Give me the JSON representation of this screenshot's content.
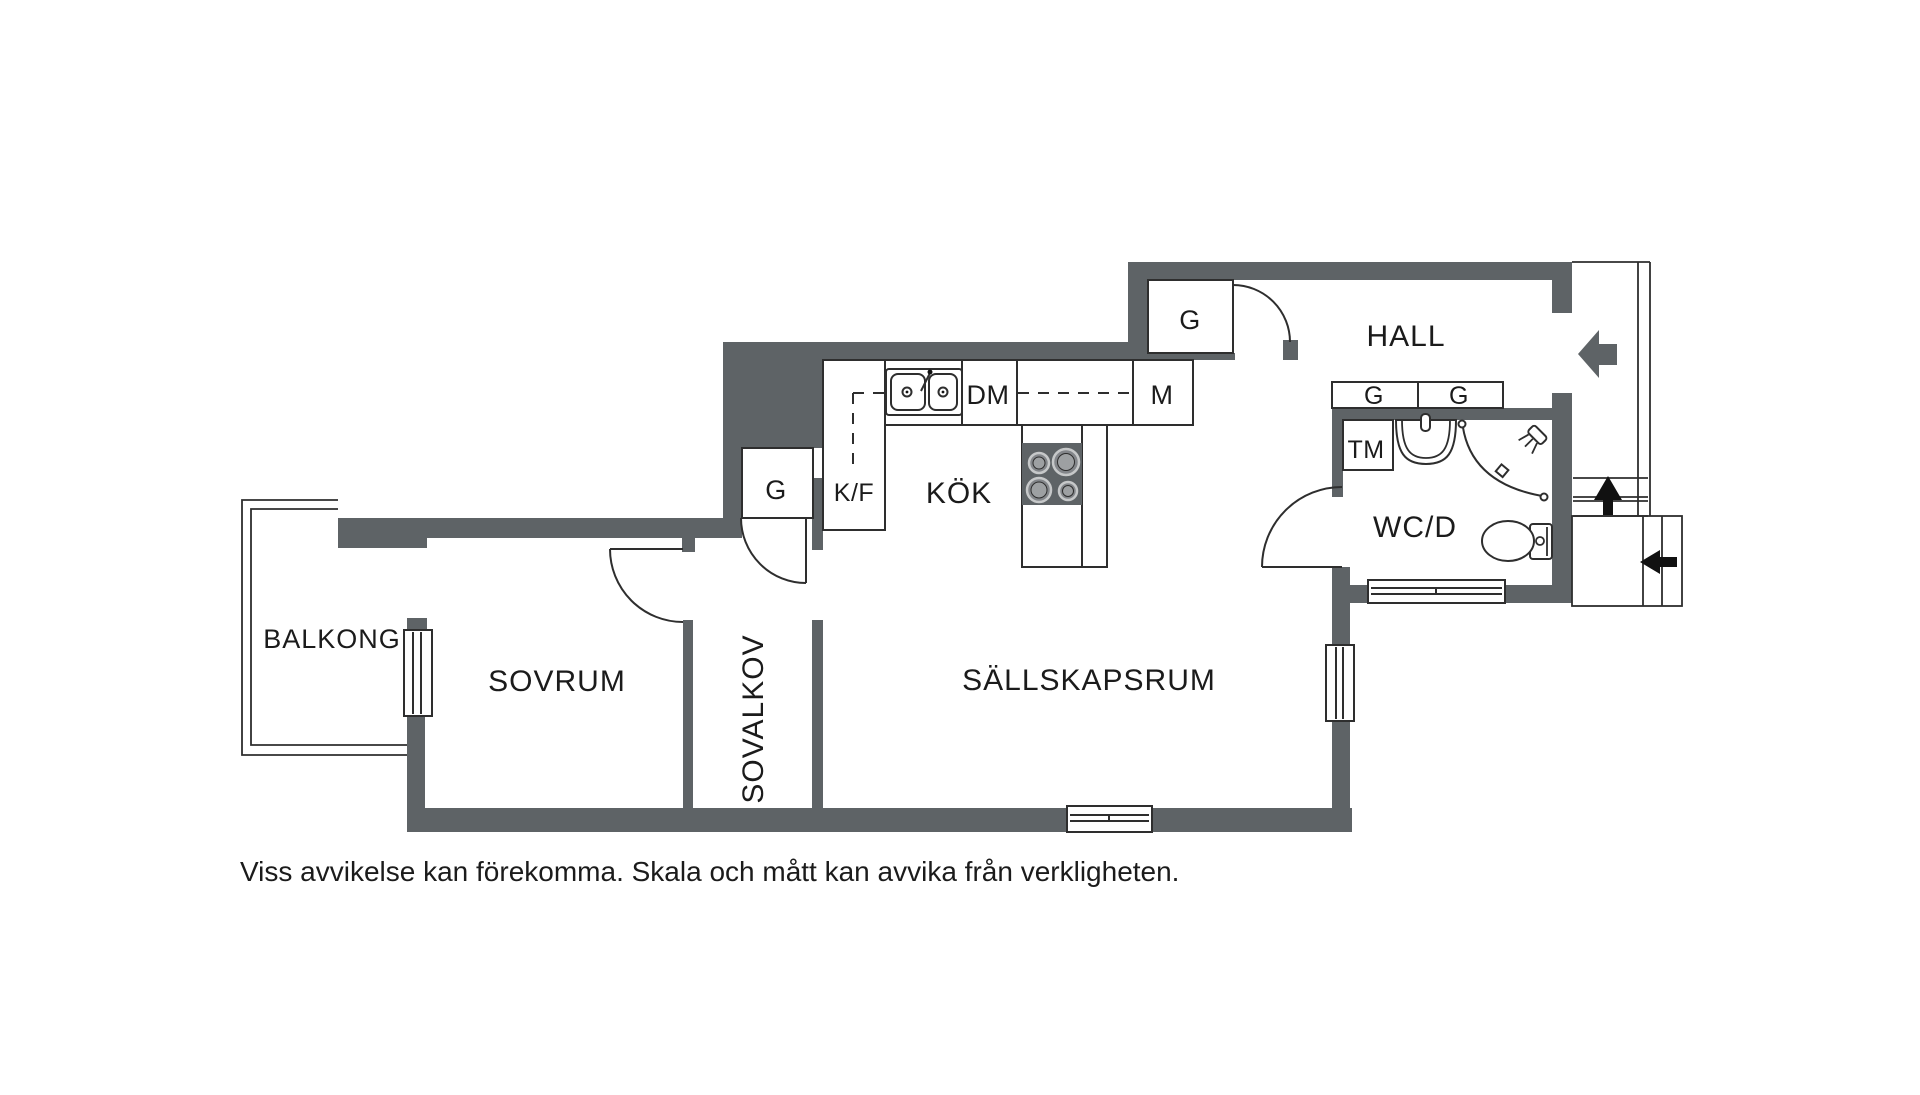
{
  "plan": {
    "colors": {
      "wall": "#5e6366",
      "line": "#2e2e2e",
      "text": "#1b1b1b",
      "black": "#111111",
      "burner_ring": "#c6c8c9",
      "burner_fill": "#83868a",
      "burner_center": "#9da0a2"
    },
    "rooms": {
      "balkong": "BALKONG",
      "sovrum": "SOVRUM",
      "sovalkov": "SOVALKOV",
      "sallskapsrum": "SÄLLSKAPSRUM",
      "kok": "KÖK",
      "hall": "HALL",
      "wcd": "WC/D"
    },
    "fixtures": {
      "kf": "K/F",
      "dm": "DM",
      "m": "M",
      "tm": "TM",
      "g_kitchen": "G",
      "g_hall": "G",
      "g_wc_left": "G",
      "g_wc_right": "G"
    }
  },
  "footer": {
    "disclaimer": "Viss avvikelse kan förekomma. Skala och mått kan avvika från verkligheten."
  }
}
